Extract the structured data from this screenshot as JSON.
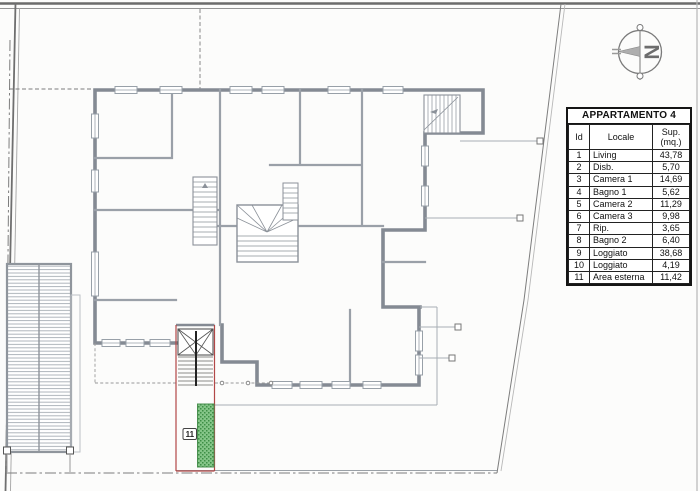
{
  "document": {
    "type": "scanned floor plan drawing"
  },
  "compass": {
    "letter": "N"
  },
  "plan": {
    "area_label": "11"
  },
  "table": {
    "title": "APPARTAMENTO 4",
    "columns": {
      "id": "Id",
      "locale": "Locale",
      "sup_line1": "Sup.",
      "sup_line2": "(mq.)"
    },
    "rows": [
      {
        "id": "1",
        "locale": "Living",
        "sup": "43,78"
      },
      {
        "id": "2",
        "locale": "Disb.",
        "sup": "5,70"
      },
      {
        "id": "3",
        "locale": "Camera 1",
        "sup": "14,69"
      },
      {
        "id": "4",
        "locale": "Bagno 1",
        "sup": "5,62"
      },
      {
        "id": "5",
        "locale": "Camera 2",
        "sup": "11,29"
      },
      {
        "id": "6",
        "locale": "Camera 3",
        "sup": "9,98"
      },
      {
        "id": "7",
        "locale": "Rip.",
        "sup": "3,65"
      },
      {
        "id": "8",
        "locale": "Bagno 2",
        "sup": "6,40"
      },
      {
        "id": "9",
        "locale": "Loggiato",
        "sup": "38,68"
      },
      {
        "id": "10",
        "locale": "Loggiato",
        "sup": "4,19"
      },
      {
        "id": "11",
        "locale": "Area esterna",
        "sup": "11,42"
      }
    ]
  },
  "colors": {
    "wall_gray": "#848a93",
    "boundary_gray": "#7d7d7d",
    "stair_strip_red": "#b24747",
    "garden_green": "#85c588",
    "garden_green_dark": "#3e8e46",
    "table_border": "#151515"
  }
}
